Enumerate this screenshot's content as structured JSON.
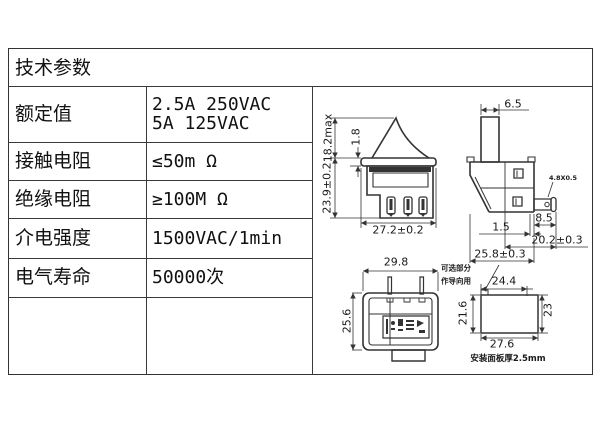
{
  "table": {
    "header": "技术参数",
    "rows": [
      {
        "label": "额定值",
        "value": "2.5A 250VAC",
        "value2": "5A 125VAC"
      },
      {
        "label": "接触电阻",
        "value": "≤50m Ω"
      },
      {
        "label": "绝缘电阻",
        "value": "≥100M Ω"
      },
      {
        "label": "介电强度",
        "value": "1500VAC/1min"
      },
      {
        "label": "电气寿命",
        "value": "50000次"
      }
    ]
  },
  "drawings": {
    "front_view": {
      "dim_height_max": "18.2max",
      "dim_bezel_thickness": "1.8",
      "dim_body_height": "23.9±0.2",
      "dim_width": "27.2±0.2"
    },
    "side_view": {
      "dim_button_width": "6.5",
      "dim_terminal": "4.8X0.5",
      "dim_terminal_length": "8.5",
      "dim_step": "1.5",
      "dim_depth_with_terminal": "20.2±0.3",
      "dim_body_depth": "25.8±0.3"
    },
    "bottom_view": {
      "dim_width": "29.8",
      "dim_height": "25.6"
    },
    "panel_cutout": {
      "note_line1": "可选部分",
      "note_line2": "作导向用",
      "dim_top_width": "24.4",
      "dim_left_height": "21.6",
      "dim_right_height": "23",
      "dim_bottom_width": "27.6",
      "caption": "安装面板厚2.5mm"
    }
  },
  "colors": {
    "line": "#333333",
    "text": "#111111",
    "background": "#ffffff"
  }
}
